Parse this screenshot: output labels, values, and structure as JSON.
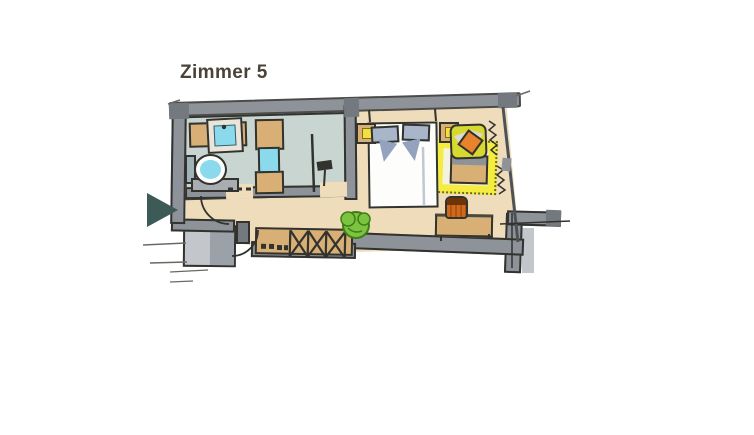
{
  "title": "Zimmer 5",
  "icons": {
    "entrance_arrow": "triangle-right"
  },
  "colors": {
    "background": "#ffffff",
    "title_text": "#4a4337",
    "outline": "#32322e",
    "wall": "#8e939a",
    "wall_dark": "#74797f",
    "floor_wood": "#eedcba",
    "floor_bath": "#c9d5d1",
    "wood": "#d8b076",
    "water_blue": "#8ad9ec",
    "sink_frame": "#e9e5da",
    "toilet_tank": "#9fb3b9",
    "cabinet_gray": "#a9adb2",
    "bed_white": "#fdfdfc",
    "pillow_blue": "#a9b5c9",
    "pillow_fold": "#93a3bd",
    "lamp_yellow": "#f2e042",
    "armchair_yellow": "#d6d930",
    "chair_wedge": "#d9dad0",
    "rug_yellow": "#f4ec3f",
    "rug_center": "#f6f2e3",
    "accent_orange": "#e8832c",
    "stool_orange": "#d06a1a",
    "stool_dark": "#6e3408",
    "plant_green": "#7cc340",
    "plant_dark": "#3f7d18",
    "vestibule_gray": "#c3c6cb",
    "vestibule_dark": "#9ba1a9",
    "arrow_teal": "#3c5a56",
    "sketch_gray": "#6a6a62",
    "fold_gray": "#c2c8d2"
  }
}
